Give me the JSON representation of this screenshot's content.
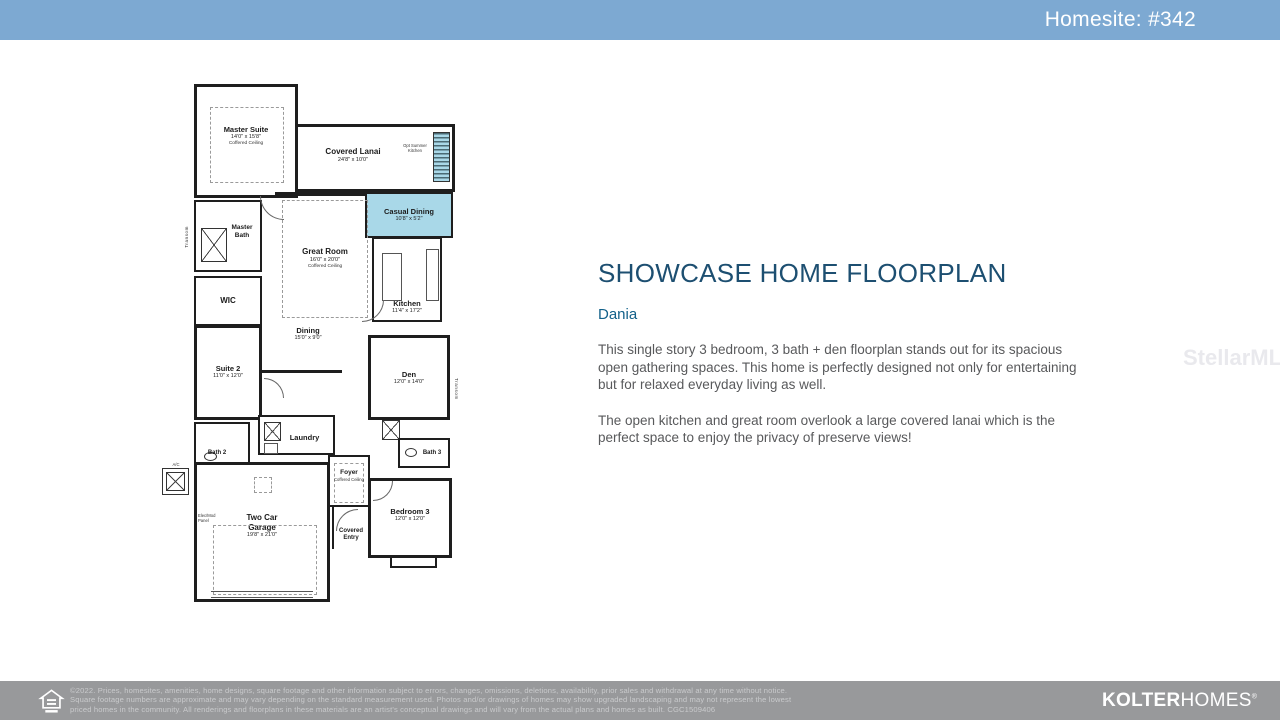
{
  "header": {
    "homesite_label": "Homesite: #342",
    "bg_color": "#7da9d2"
  },
  "main": {
    "title": "SHOWCASE HOME FLOORPLAN",
    "plan_name": "Dania",
    "paragraph1": "This single story 3 bedroom, 3 bath + den floorplan stands out for its spacious open gathering spaces. This home is perfectly designed not only for entertaining but for relaxed everyday living as well.",
    "paragraph2": "The open kitchen and great room overlook a large covered lanai which is the perfect space to enjoy the privacy of preserve views!",
    "title_color": "#1d4f71"
  },
  "watermark": "StellarMLS",
  "floorplan": {
    "highlight_color": "#a9d8e8",
    "rooms": {
      "master_suite": {
        "name": "Master Suite",
        "dims": "14'0\" x 15'8\"",
        "note": "Coffered Ceiling"
      },
      "covered_lanai": {
        "name": "Covered Lanai",
        "dims": "24'8\" x 10'0\""
      },
      "opt_summer_kitchen": {
        "name": "Opt Summer Kitchen"
      },
      "casual_dining": {
        "name": "Casual Dining",
        "dims": "10'8\" x 5'2\""
      },
      "great_room": {
        "name": "Great Room",
        "dims": "16'0\" x 20'0\"",
        "note": "Coffered Ceiling"
      },
      "master_bath": {
        "name": "Master Bath"
      },
      "wic": {
        "name": "WIC"
      },
      "kitchen": {
        "name": "Kitchen",
        "dims": "11'4\" x 17'2\""
      },
      "dining": {
        "name": "Dining",
        "dims": "15'0\" x 9'0\""
      },
      "suite2": {
        "name": "Suite 2",
        "dims": "11'0\" x 12'0\""
      },
      "den": {
        "name": "Den",
        "dims": "12'0\" x 14'0\""
      },
      "bath2": {
        "name": "Bath 2"
      },
      "laundry": {
        "name": "Laundry"
      },
      "bath3": {
        "name": "Bath 3"
      },
      "foyer": {
        "name": "Foyer",
        "note": "Coffered Ceiling"
      },
      "garage": {
        "name": "Two Car Garage",
        "dims": "19'8\" x 21'0\""
      },
      "covered_entry": {
        "name": "Covered Entry"
      },
      "bedroom3": {
        "name": "Bedroom 3",
        "dims": "12'0\" x 12'0\""
      }
    },
    "annotations": {
      "transom_left": "Transom",
      "transom_right": "Transom",
      "ac": "A/C",
      "elec_panel": "Elec/Mod Panel"
    }
  },
  "footer": {
    "legal_lines": [
      "©2022. Prices, homesites, amenities, home designs, square footage and other information subject to errors, changes, omissions, deletions, availability, prior sales and withdrawal at any time without notice.",
      "Square footage numbers are approximate and may vary depending on the standard measurement used. Photos and/or drawings of homes may show upgraded landscaping and may not represent the lowest",
      "priced homes in the community. All renderings and floorplans in these materials are an artist's conceptual drawings and will vary from the actual plans and homes as built. CGC1509406"
    ],
    "logo_bold": "KOLTER",
    "logo_light": "HOMES",
    "logo_reg": "®",
    "bg_color": "#98999b"
  }
}
